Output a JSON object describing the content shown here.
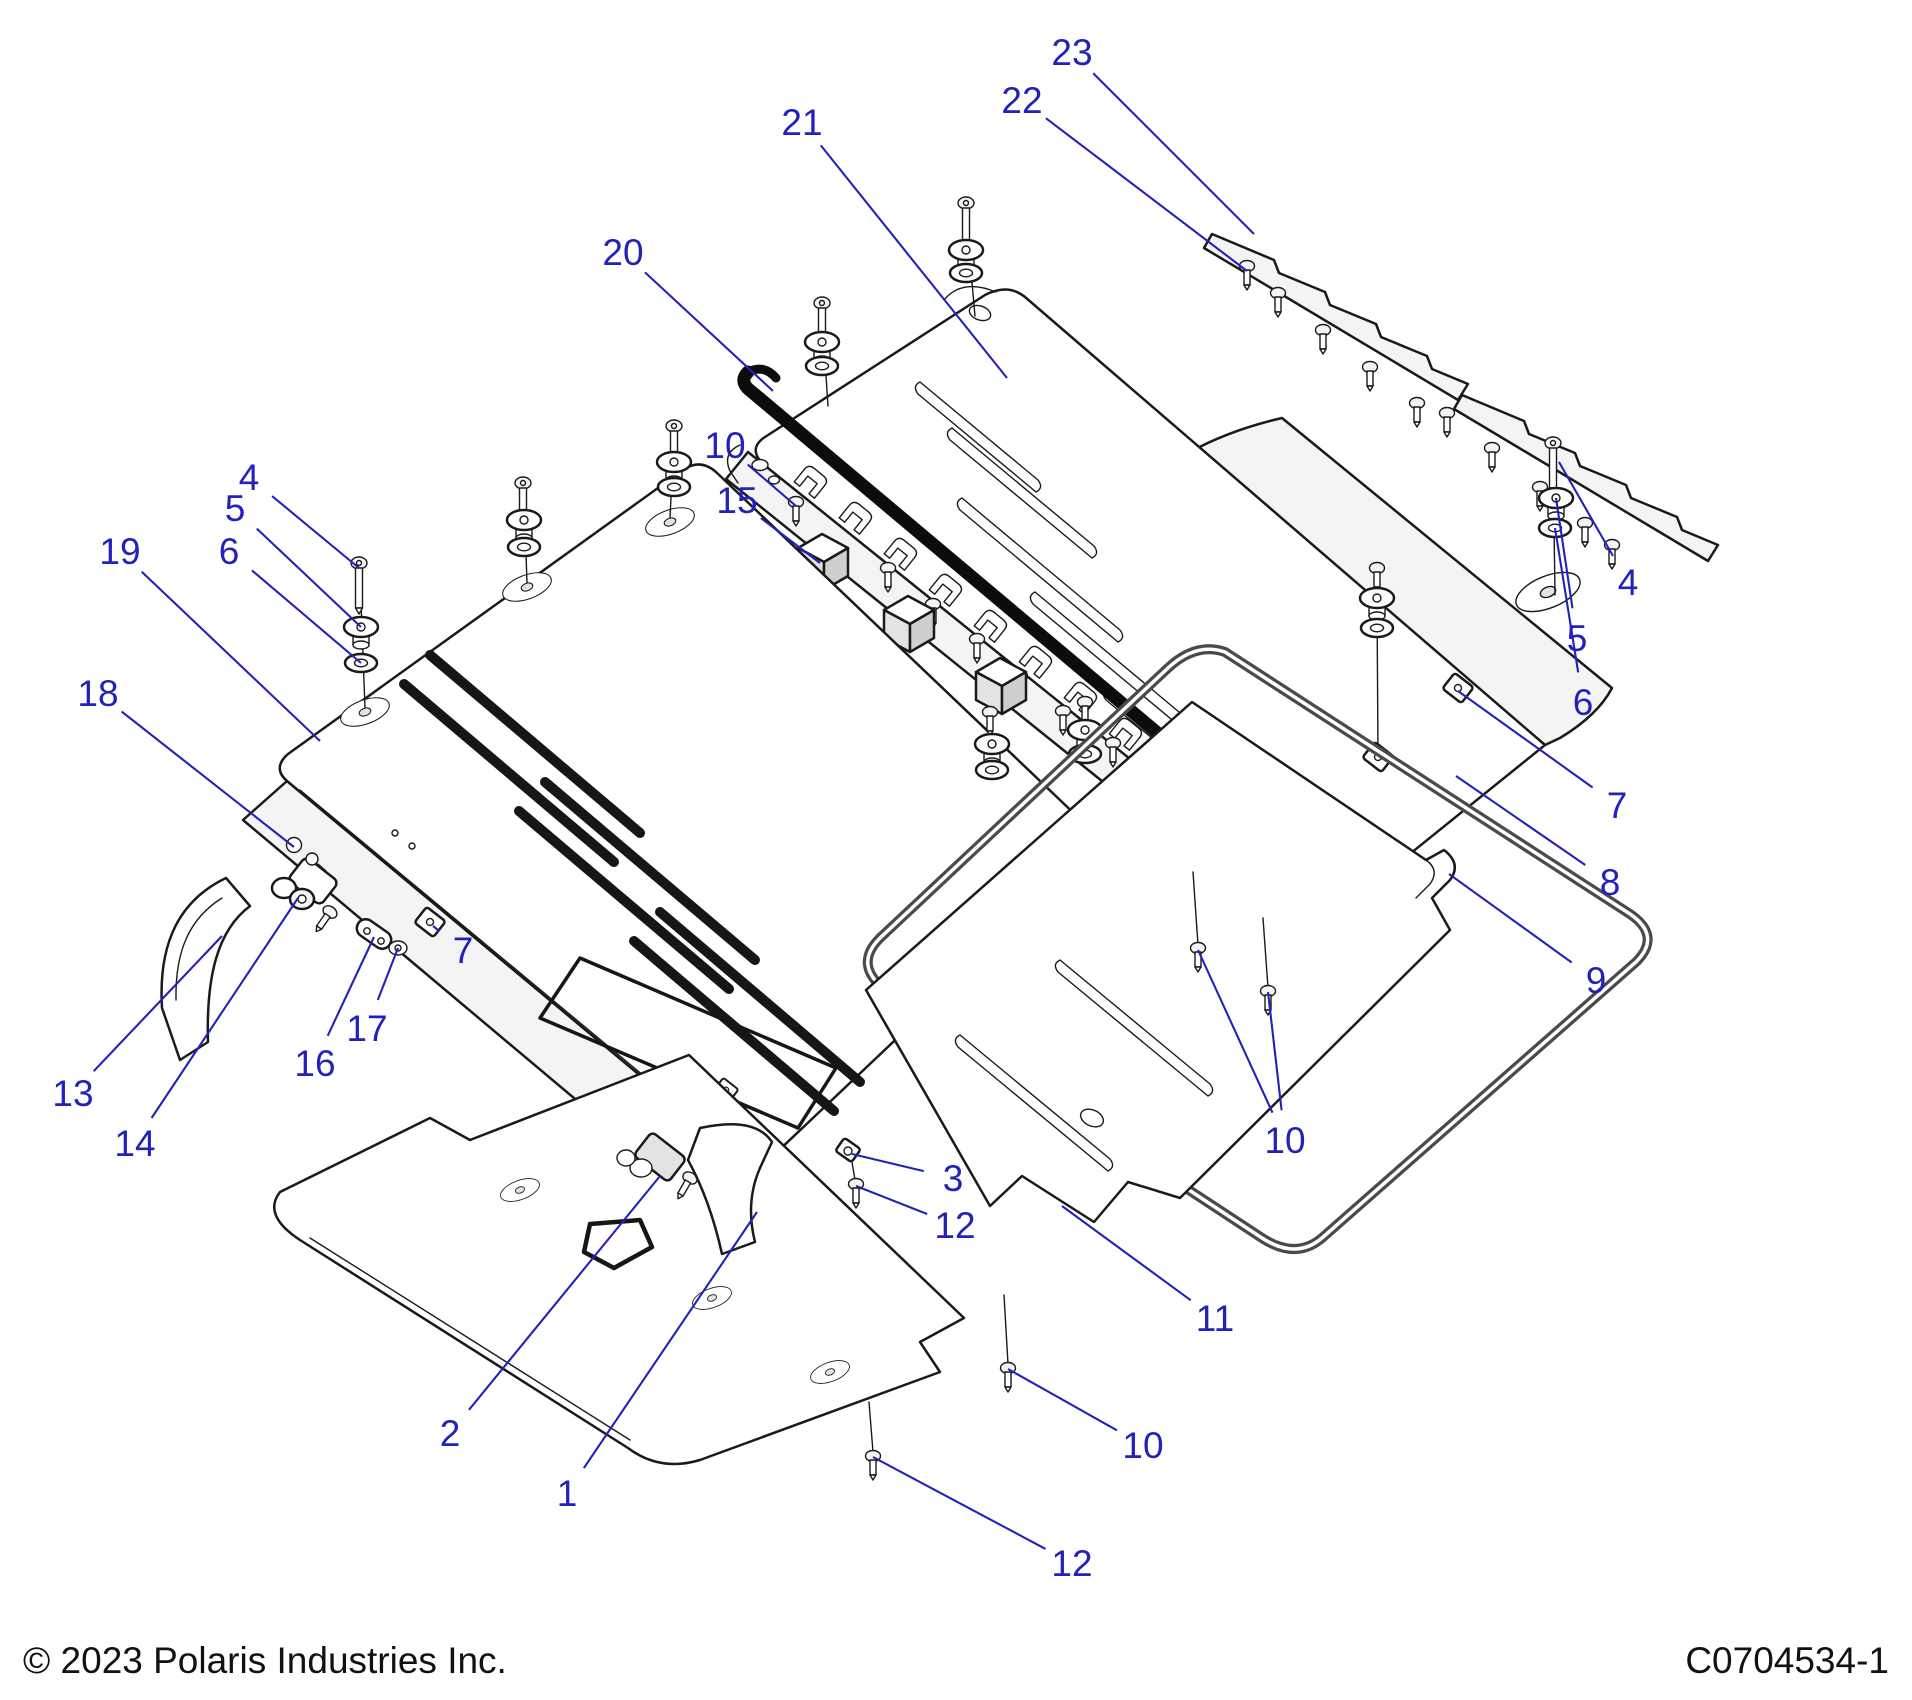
{
  "footer": {
    "copyright": "© 2023 Polaris Industries Inc.",
    "document_code": "C0704534-1"
  },
  "callout_style": {
    "color": "#2222bb",
    "font_size": 37,
    "leader_width": 2.1,
    "label_gap": 30
  },
  "callouts": [
    {
      "n": "1",
      "x": 567,
      "y": 1493,
      "t": [
        [
          757,
          1212
        ]
      ]
    },
    {
      "n": "2",
      "x": 450,
      "y": 1433,
      "t": [
        [
          660,
          1176
        ]
      ]
    },
    {
      "n": "3",
      "x": 953,
      "y": 1178,
      "t": [
        [
          852,
          1154
        ]
      ]
    },
    {
      "n": "4",
      "x": 249,
      "y": 477,
      "t": [
        [
          359,
          568
        ]
      ]
    },
    {
      "n": "5",
      "x": 235,
      "y": 508,
      "t": [
        [
          361,
          627
        ]
      ]
    },
    {
      "n": "6",
      "x": 229,
      "y": 551,
      "t": [
        [
          361,
          663
        ]
      ]
    },
    {
      "n": "4",
      "x": 1628,
      "y": 582,
      "t": [
        [
          1559,
          462
        ]
      ]
    },
    {
      "n": "5",
      "x": 1577,
      "y": 638,
      "t": [
        [
          1556,
          498
        ]
      ]
    },
    {
      "n": "6",
      "x": 1583,
      "y": 702,
      "t": [
        [
          1555,
          528
        ]
      ]
    },
    {
      "n": "7",
      "x": 463,
      "y": 950,
      "t": [
        [
          433,
          926
        ]
      ]
    },
    {
      "n": "7",
      "x": 1617,
      "y": 805,
      "t": [
        [
          1458,
          691
        ]
      ]
    },
    {
      "n": "8",
      "x": 1610,
      "y": 882,
      "t": [
        [
          1456,
          776
        ]
      ]
    },
    {
      "n": "9",
      "x": 1596,
      "y": 980,
      "t": [
        [
          1449,
          874
        ]
      ]
    },
    {
      "n": "10",
      "x": 725,
      "y": 445,
      "t": [
        [
          796,
          506
        ]
      ]
    },
    {
      "n": "10",
      "x": 1285,
      "y": 1140,
      "t": [
        [
          1198,
          950
        ],
        [
          1268,
          992
        ]
      ]
    },
    {
      "n": "10",
      "x": 1143,
      "y": 1445,
      "t": [
        [
          1008,
          1369
        ]
      ]
    },
    {
      "n": "11",
      "x": 1215,
      "y": 1318,
      "t": [
        [
          1062,
          1206
        ]
      ]
    },
    {
      "n": "12",
      "x": 955,
      "y": 1225,
      "t": [
        [
          856,
          1186
        ]
      ]
    },
    {
      "n": "12",
      "x": 1072,
      "y": 1563,
      "t": [
        [
          873,
          1457
        ]
      ]
    },
    {
      "n": "13",
      "x": 73,
      "y": 1093,
      "t": [
        [
          222,
          936
        ]
      ]
    },
    {
      "n": "14",
      "x": 135,
      "y": 1143,
      "t": [
        [
          298,
          898
        ]
      ]
    },
    {
      "n": "15",
      "x": 737,
      "y": 500,
      "t": [
        [
          820,
          563
        ]
      ]
    },
    {
      "n": "16",
      "x": 315,
      "y": 1063,
      "t": [
        [
          374,
          937
        ]
      ]
    },
    {
      "n": "17",
      "x": 367,
      "y": 1028,
      "t": [
        [
          398,
          948
        ]
      ]
    },
    {
      "n": "18",
      "x": 98,
      "y": 693,
      "t": [
        [
          294,
          847
        ]
      ]
    },
    {
      "n": "19",
      "x": 120,
      "y": 551,
      "t": [
        [
          320,
          741
        ]
      ]
    },
    {
      "n": "20",
      "x": 623,
      "y": 252,
      "t": [
        [
          773,
          391
        ]
      ]
    },
    {
      "n": "21",
      "x": 802,
      "y": 122,
      "t": [
        [
          1007,
          378
        ]
      ]
    },
    {
      "n": "22",
      "x": 1022,
      "y": 100,
      "t": [
        [
          1247,
          271
        ]
      ]
    },
    {
      "n": "23",
      "x": 1072,
      "y": 52,
      "t": [
        [
          1254,
          234
        ]
      ]
    }
  ]
}
